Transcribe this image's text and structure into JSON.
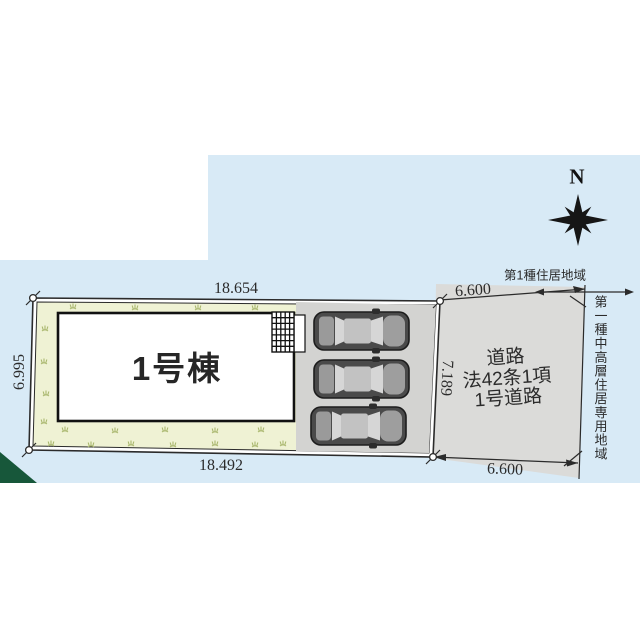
{
  "compass": {
    "north_label": "N"
  },
  "site": {
    "building_label": "1号棟",
    "dim_top": "18.654",
    "dim_bottom": "18.492",
    "dim_left": "6.995"
  },
  "road": {
    "labels": [
      "道路",
      "法42条1項",
      "1号道路"
    ],
    "dim_top": "6.600",
    "dim_bottom": "6.600",
    "dim_side": "7.189"
  },
  "zoning": {
    "left_area_label": "第1種住居地域",
    "right_area_label": "第一種中高層住居専用地域"
  },
  "colors": {
    "sky_blue": "#d8eaf6",
    "lawn_cream": "#eff2d4",
    "road_gray": "#dbdbd9",
    "parking_gray": "#d3d3d1",
    "corner_green": "#17573a",
    "line_dark": "#2b2b2b"
  }
}
